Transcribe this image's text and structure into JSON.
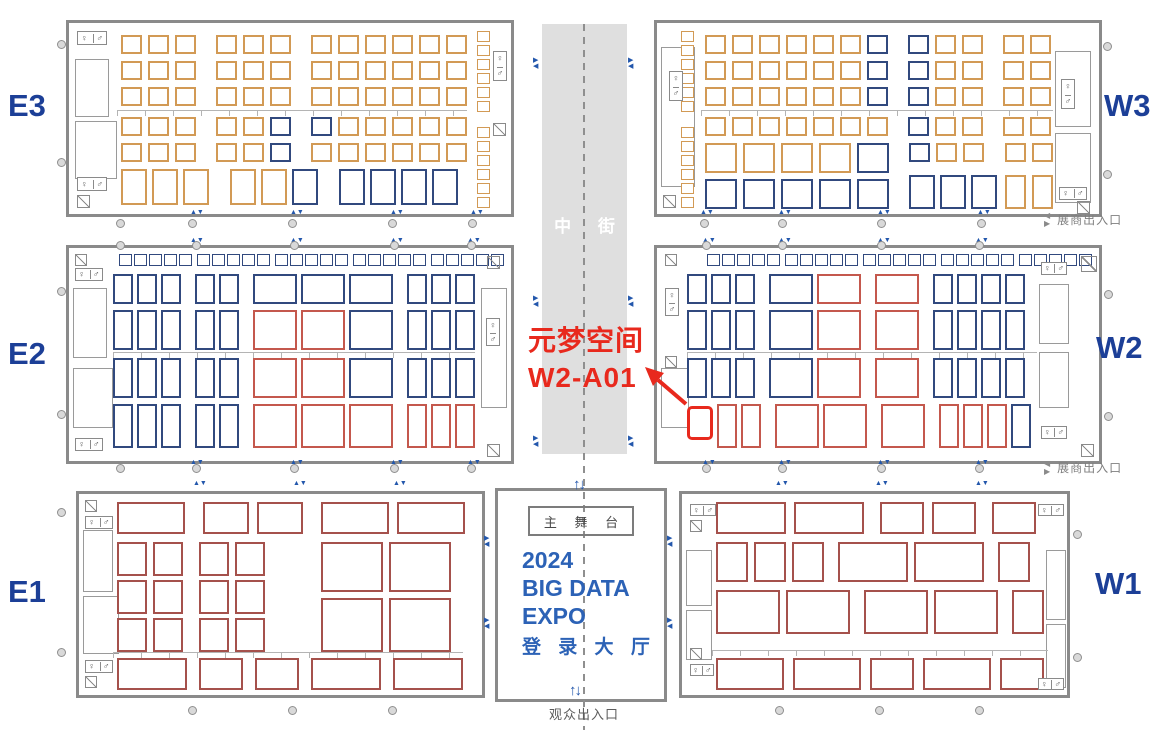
{
  "colors": {
    "orange": "#D29A55",
    "navy": "#31497E",
    "red": "#C4584D",
    "darkred": "#A5514C",
    "highlight": "#E8291D",
    "wall": "#8A8A8A",
    "corridor": "#DFDFDF",
    "doorblue": "#2357AC",
    "hall_label_blue": "#1C3F97",
    "expo_blue": "#2C62B6"
  },
  "labels": {
    "corridor": "中 街",
    "audience_exit": "观众出入口",
    "exhibitor_exit": "展商出入口",
    "stage": "主 舞 台",
    "expo_line1": "2024",
    "expo_line2": "BIG DATA",
    "expo_line3": "EXPO",
    "lobby": "登 录 大 厅",
    "entrance_arrows": "↑↓",
    "wc_female": "♀",
    "wc_male": "♂"
  },
  "annotation": {
    "line1": "元梦空间",
    "line2": "W2-A01",
    "target_booth": "W2-A01"
  },
  "halls": [
    {
      "id": "e3",
      "label": "E3",
      "x": 66,
      "y": 20,
      "w": 448,
      "h": 197,
      "lx": 8,
      "ly": 88,
      "rows": [
        {
          "x": 52,
          "y": 12,
          "w": 21,
          "h": 19,
          "gap": 6,
          "aisle": 14,
          "cells": "ooo ooo oooooo"
        },
        {
          "x": 52,
          "y": 38,
          "w": 21,
          "h": 19,
          "gap": 6,
          "aisle": 14,
          "cells": "ooo ooo oooooo"
        },
        {
          "x": 52,
          "y": 64,
          "w": 21,
          "h": 19,
          "gap": 6,
          "aisle": 14,
          "cells": "ooo ooo oooooo"
        },
        {
          "x": 52,
          "y": 94,
          "w": 21,
          "h": 19,
          "gap": 6,
          "aisle": 14,
          "cells": "ooo oon nooooo"
        },
        {
          "x": 52,
          "y": 120,
          "w": 21,
          "h": 19,
          "gap": 6,
          "aisle": 14,
          "cells": "ooo oon oooooo"
        },
        {
          "x": 52,
          "y": 146,
          "w": 26,
          "h": 36,
          "gap": 5,
          "aisle": 16,
          "wide": 34,
          "cells": "ooo oon nnnn"
        }
      ],
      "strips": [
        {
          "x": 408,
          "y": 8,
          "w": 13,
          "h": 11,
          "count": 6,
          "dy": 14,
          "color": "o"
        },
        {
          "x": 408,
          "y": 104,
          "w": 13,
          "h": 11,
          "count": 6,
          "dy": 14,
          "color": "o"
        }
      ],
      "rooms": [
        {
          "x": 6,
          "y": 36,
          "w": 34,
          "h": 58
        },
        {
          "x": 6,
          "y": 98,
          "w": 42,
          "h": 58
        }
      ],
      "wc": [
        {
          "x": 8,
          "y": 8,
          "w": 30,
          "h": 14
        },
        {
          "x": 8,
          "y": 154,
          "w": 30,
          "h": 14
        },
        {
          "x": 424,
          "y": 28,
          "w": 14,
          "h": 30,
          "vert": true
        }
      ],
      "diag": [
        {
          "x": 8,
          "y": 172,
          "s": 13
        },
        {
          "x": 424,
          "y": 100,
          "s": 13
        }
      ],
      "dim": [
        {
          "x": 48,
          "y": 87,
          "w": 350
        }
      ]
    },
    {
      "id": "w3",
      "label": "W3",
      "x": 654,
      "y": 20,
      "w": 448,
      "h": 197,
      "lx": 1104,
      "ly": 88,
      "rows": [
        {
          "x": 48,
          "y": 12,
          "w": 21,
          "h": 19,
          "gap": 6,
          "aisle": 14,
          "cells": "oooooon noo oo"
        },
        {
          "x": 48,
          "y": 38,
          "w": 21,
          "h": 19,
          "gap": 6,
          "aisle": 14,
          "cells": "oooooon noo oo"
        },
        {
          "x": 48,
          "y": 64,
          "w": 21,
          "h": 19,
          "gap": 6,
          "aisle": 14,
          "cells": "oooooon noo oo"
        },
        {
          "x": 48,
          "y": 94,
          "w": 21,
          "h": 19,
          "gap": 6,
          "aisle": 14,
          "cells": "ooooooo noo oo"
        },
        {
          "x": 48,
          "y": 120,
          "w": 32,
          "h": 30,
          "gap": 6,
          "cells": "oooon"
        },
        {
          "x": 252,
          "y": 120,
          "w": 21,
          "h": 19,
          "gap": 6,
          "cells": "noo"
        },
        {
          "x": 348,
          "y": 120,
          "w": 21,
          "h": 19,
          "gap": 6,
          "cells": "oo"
        },
        {
          "x": 48,
          "y": 156,
          "w": 32,
          "h": 30,
          "gap": 6,
          "cells": "nnnnn"
        },
        {
          "x": 252,
          "y": 152,
          "w": 26,
          "h": 34,
          "gap": 5,
          "cells": "nnn"
        },
        {
          "x": 348,
          "y": 152,
          "w": 21,
          "h": 34,
          "gap": 6,
          "cells": "oo"
        }
      ],
      "strips": [
        {
          "x": 24,
          "y": 8,
          "w": 13,
          "h": 11,
          "count": 6,
          "dy": 14,
          "color": "o"
        },
        {
          "x": 24,
          "y": 104,
          "w": 13,
          "h": 11,
          "count": 6,
          "dy": 14,
          "color": "o"
        }
      ],
      "rooms": [
        {
          "x": 4,
          "y": 24,
          "w": 34,
          "h": 140
        },
        {
          "x": 398,
          "y": 28,
          "w": 36,
          "h": 76
        },
        {
          "x": 398,
          "y": 110,
          "w": 36,
          "h": 70
        }
      ],
      "wc": [
        {
          "x": 12,
          "y": 48,
          "w": 14,
          "h": 30,
          "vert": true
        },
        {
          "x": 404,
          "y": 56,
          "w": 14,
          "h": 30,
          "vert": true
        },
        {
          "x": 402,
          "y": 164,
          "w": 28,
          "h": 13
        }
      ],
      "diag": [
        {
          "x": 6,
          "y": 172,
          "s": 13
        },
        {
          "x": 420,
          "y": 178,
          "s": 13
        }
      ],
      "dim": [
        {
          "x": 44,
          "y": 87,
          "w": 352
        }
      ]
    },
    {
      "id": "e2",
      "label": "E2",
      "x": 66,
      "y": 245,
      "w": 448,
      "h": 219,
      "lx": 8,
      "ly": 336,
      "rows": [
        {
          "x": 44,
          "y": 26,
          "w": 20,
          "h": 30,
          "gap": 4,
          "aisle": 10,
          "wide": 44,
          "cells": "nnn nn NNN nnn"
        },
        {
          "x": 44,
          "y": 62,
          "w": 20,
          "h": 40,
          "gap": 4,
          "aisle": 10,
          "wide": 44,
          "cells": "nnn nn RRN nnn"
        },
        {
          "x": 44,
          "y": 110,
          "w": 20,
          "h": 40,
          "gap": 4,
          "aisle": 10,
          "wide": 44,
          "cells": "nnn nn RRN nnn"
        },
        {
          "x": 44,
          "y": 156,
          "w": 20,
          "h": 44,
          "gap": 4,
          "aisle": 10,
          "wide": 44,
          "cells": "nnn nn RRR rrr"
        }
      ],
      "strips": [
        {
          "x": 50,
          "y": 6,
          "w": 13,
          "h": 12,
          "count": 5,
          "dx": 15,
          "color": "n"
        },
        {
          "x": 128,
          "y": 6,
          "w": 13,
          "h": 12,
          "count": 5,
          "dx": 15,
          "color": "n"
        },
        {
          "x": 206,
          "y": 6,
          "w": 13,
          "h": 12,
          "count": 5,
          "dx": 15,
          "color": "n"
        },
        {
          "x": 284,
          "y": 6,
          "w": 13,
          "h": 12,
          "count": 5,
          "dx": 15,
          "color": "n"
        },
        {
          "x": 362,
          "y": 6,
          "w": 13,
          "h": 12,
          "count": 5,
          "dx": 15,
          "color": "n"
        }
      ],
      "rooms": [
        {
          "x": 4,
          "y": 40,
          "w": 34,
          "h": 70
        },
        {
          "x": 4,
          "y": 120,
          "w": 40,
          "h": 60
        },
        {
          "x": 412,
          "y": 40,
          "w": 26,
          "h": 120
        }
      ],
      "wc": [
        {
          "x": 6,
          "y": 20,
          "w": 28,
          "h": 13
        },
        {
          "x": 6,
          "y": 190,
          "w": 28,
          "h": 13
        },
        {
          "x": 417,
          "y": 70,
          "w": 14,
          "h": 28,
          "vert": true
        }
      ],
      "diag": [
        {
          "x": 6,
          "y": 6,
          "s": 12
        },
        {
          "x": 418,
          "y": 8,
          "s": 13
        },
        {
          "x": 418,
          "y": 196,
          "s": 13
        }
      ],
      "dim": [
        {
          "x": 44,
          "y": 104,
          "w": 362
        }
      ]
    },
    {
      "id": "w2",
      "label": "W2",
      "x": 654,
      "y": 245,
      "w": 448,
      "h": 219,
      "lx": 1096,
      "ly": 330,
      "rows": [
        {
          "x": 30,
          "y": 26,
          "w": 20,
          "h": 30,
          "gap": 4,
          "aisle": 10,
          "wide": 44,
          "cells": "nnn NR R nnnn"
        },
        {
          "x": 30,
          "y": 62,
          "w": 20,
          "h": 40,
          "gap": 4,
          "aisle": 10,
          "wide": 44,
          "cells": "nnn NR R nnnn"
        },
        {
          "x": 30,
          "y": 110,
          "w": 20,
          "h": 40,
          "gap": 4,
          "aisle": 10,
          "wide": 44,
          "cells": "nnn NR R nnnn"
        },
        {
          "x": 30,
          "y": 156,
          "w": 20,
          "h": 44,
          "gap": 4,
          "aisle": 10,
          "wide": 44,
          "cells": "hrr RR R rrrn"
        }
      ],
      "strips": [
        {
          "x": 50,
          "y": 6,
          "w": 13,
          "h": 12,
          "count": 5,
          "dx": 15,
          "color": "n"
        },
        {
          "x": 128,
          "y": 6,
          "w": 13,
          "h": 12,
          "count": 5,
          "dx": 15,
          "color": "n"
        },
        {
          "x": 206,
          "y": 6,
          "w": 13,
          "h": 12,
          "count": 5,
          "dx": 15,
          "color": "n"
        },
        {
          "x": 284,
          "y": 6,
          "w": 13,
          "h": 12,
          "count": 5,
          "dx": 15,
          "color": "n"
        },
        {
          "x": 362,
          "y": 6,
          "w": 13,
          "h": 12,
          "count": 5,
          "dx": 15,
          "color": "n"
        }
      ],
      "rooms": [
        {
          "x": 382,
          "y": 36,
          "w": 30,
          "h": 60
        },
        {
          "x": 382,
          "y": 104,
          "w": 30,
          "h": 56
        },
        {
          "x": 4,
          "y": 120,
          "w": 28,
          "h": 60
        }
      ],
      "wc": [
        {
          "x": 8,
          "y": 40,
          "w": 14,
          "h": 28,
          "vert": true
        },
        {
          "x": 384,
          "y": 14,
          "w": 26,
          "h": 13
        },
        {
          "x": 384,
          "y": 178,
          "w": 26,
          "h": 13
        }
      ],
      "diag": [
        {
          "x": 8,
          "y": 6,
          "s": 12
        },
        {
          "x": 8,
          "y": 108,
          "s": 12
        },
        {
          "x": 424,
          "y": 8,
          "s": 16
        },
        {
          "x": 424,
          "y": 196,
          "s": 13
        }
      ],
      "dim": [
        {
          "x": 30,
          "y": 104,
          "w": 350
        }
      ]
    },
    {
      "id": "e1",
      "label": "E1",
      "x": 76,
      "y": 491,
      "w": 409,
      "h": 207,
      "lx": 8,
      "ly": 574,
      "rows": [
        {
          "x": 38,
          "y": 8,
          "w": 46,
          "wide": 68,
          "h": 32,
          "gap": 8,
          "aisle": 10,
          "cells": "D dd DD"
        },
        {
          "x": 38,
          "y": 48,
          "w": 30,
          "h": 34,
          "gap": 6,
          "aisle": 10,
          "cells": "dd dd"
        },
        {
          "x": 38,
          "y": 86,
          "w": 30,
          "h": 34,
          "gap": 6,
          "aisle": 10,
          "cells": "dd dd"
        },
        {
          "x": 38,
          "y": 124,
          "w": 30,
          "h": 34,
          "gap": 6,
          "aisle": 10,
          "cells": "dd dd"
        },
        {
          "x": 242,
          "y": 48,
          "w": 62,
          "h": 50,
          "gap": 6,
          "cells": "dd"
        },
        {
          "x": 242,
          "y": 104,
          "w": 62,
          "h": 54,
          "gap": 6,
          "cells": "dd"
        },
        {
          "x": 38,
          "y": 164,
          "w": 44,
          "wide": 70,
          "h": 32,
          "gap": 6,
          "aisle": 6,
          "cells": "D d d D D"
        }
      ],
      "rooms": [
        {
          "x": 4,
          "y": 36,
          "w": 30,
          "h": 62
        },
        {
          "x": 4,
          "y": 102,
          "w": 36,
          "h": 58
        }
      ],
      "wc": [
        {
          "x": 6,
          "y": 22,
          "w": 28,
          "h": 13
        },
        {
          "x": 6,
          "y": 166,
          "w": 28,
          "h": 13
        }
      ],
      "diag": [
        {
          "x": 6,
          "y": 6,
          "s": 12
        },
        {
          "x": 6,
          "y": 182,
          "s": 12
        }
      ],
      "dim": [
        {
          "x": 34,
          "y": 158,
          "w": 350
        }
      ]
    },
    {
      "id": "w1",
      "label": "W1",
      "x": 679,
      "y": 491,
      "w": 391,
      "h": 207,
      "lx": 1095,
      "ly": 566,
      "rows": [
        {
          "x": 34,
          "y": 8,
          "w": 44,
          "wide": 70,
          "h": 32,
          "gap": 8,
          "aisle": 8,
          "cells": "DD dd d"
        },
        {
          "x": 34,
          "y": 48,
          "w": 32,
          "wide": 70,
          "h": 40,
          "gap": 6,
          "aisle": 8,
          "cells": "ddd DD d"
        },
        {
          "x": 34,
          "y": 96,
          "w": 32,
          "wide": 64,
          "h": 44,
          "gap": 6,
          "aisle": 8,
          "cells": "DD DD d"
        },
        {
          "x": 34,
          "y": 164,
          "w": 44,
          "wide": 68,
          "h": 32,
          "gap": 5,
          "aisle": 4,
          "cells": "D D d D d"
        }
      ],
      "rooms": [
        {
          "x": 364,
          "y": 56,
          "w": 20,
          "h": 70
        },
        {
          "x": 364,
          "y": 130,
          "w": 20,
          "h": 64
        },
        {
          "x": 4,
          "y": 56,
          "w": 26,
          "h": 56
        },
        {
          "x": 4,
          "y": 116,
          "w": 26,
          "h": 50
        }
      ],
      "wc": [
        {
          "x": 8,
          "y": 10,
          "w": 26,
          "h": 12
        },
        {
          "x": 8,
          "y": 170,
          "w": 24,
          "h": 12
        },
        {
          "x": 356,
          "y": 10,
          "w": 26,
          "h": 12
        },
        {
          "x": 356,
          "y": 184,
          "w": 26,
          "h": 12
        }
      ],
      "diag": [
        {
          "x": 8,
          "y": 26,
          "s": 12
        },
        {
          "x": 8,
          "y": 154,
          "s": 12
        }
      ],
      "dim": [
        {
          "x": 30,
          "y": 156,
          "w": 336
        }
      ]
    }
  ],
  "markers": {
    "doors_v": [
      [
        190,
        209
      ],
      [
        290,
        209
      ],
      [
        390,
        209
      ],
      [
        470,
        209
      ],
      [
        700,
        209
      ],
      [
        778,
        209
      ],
      [
        877,
        209
      ],
      [
        977,
        209
      ],
      [
        190,
        237
      ],
      [
        290,
        237
      ],
      [
        390,
        237
      ],
      [
        467,
        237
      ],
      [
        702,
        237
      ],
      [
        778,
        237
      ],
      [
        877,
        237
      ],
      [
        975,
        237
      ],
      [
        190,
        459
      ],
      [
        290,
        459
      ],
      [
        390,
        459
      ],
      [
        467,
        459
      ],
      [
        702,
        459
      ],
      [
        778,
        459
      ],
      [
        877,
        459
      ],
      [
        975,
        459
      ],
      [
        193,
        480
      ],
      [
        293,
        480
      ],
      [
        393,
        480
      ],
      [
        775,
        480
      ],
      [
        875,
        480
      ],
      [
        975,
        480
      ]
    ],
    "doors_h": [
      [
        533,
        58
      ],
      [
        533,
        436
      ],
      [
        628,
        58
      ],
      [
        628,
        436
      ],
      [
        533,
        296
      ],
      [
        628,
        296
      ],
      [
        484,
        536
      ],
      [
        484,
        618
      ],
      [
        667,
        536
      ],
      [
        667,
        618
      ]
    ],
    "circles": [
      [
        57,
        40
      ],
      [
        57,
        158
      ],
      [
        116,
        219
      ],
      [
        188,
        219
      ],
      [
        288,
        219
      ],
      [
        388,
        219
      ],
      [
        468,
        219
      ],
      [
        700,
        219
      ],
      [
        778,
        219
      ],
      [
        877,
        219
      ],
      [
        977,
        219
      ],
      [
        1103,
        42
      ],
      [
        1103,
        170
      ],
      [
        57,
        287
      ],
      [
        57,
        410
      ],
      [
        116,
        241
      ],
      [
        192,
        241
      ],
      [
        290,
        241
      ],
      [
        390,
        241
      ],
      [
        467,
        241
      ],
      [
        702,
        241
      ],
      [
        778,
        241
      ],
      [
        877,
        241
      ],
      [
        975,
        241
      ],
      [
        1104,
        290
      ],
      [
        1104,
        412
      ],
      [
        116,
        464
      ],
      [
        192,
        464
      ],
      [
        290,
        464
      ],
      [
        390,
        464
      ],
      [
        467,
        464
      ],
      [
        702,
        464
      ],
      [
        778,
        464
      ],
      [
        877,
        464
      ],
      [
        975,
        464
      ],
      [
        57,
        508
      ],
      [
        57,
        648
      ],
      [
        188,
        706
      ],
      [
        288,
        706
      ],
      [
        388,
        706
      ],
      [
        775,
        706
      ],
      [
        875,
        706
      ],
      [
        975,
        706
      ],
      [
        1073,
        530
      ],
      [
        1073,
        653
      ]
    ]
  }
}
